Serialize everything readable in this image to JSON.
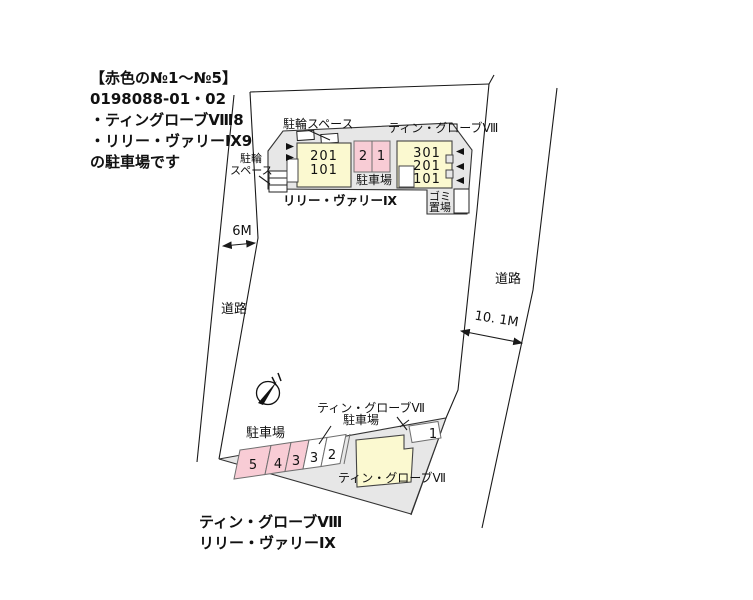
{
  "note": {
    "line1": "【赤色の№1〜№5】",
    "line2": "0198088-01・02",
    "line3": "・ティングローブⅧ8",
    "line4": "・リリー・ヴァリーⅨ9",
    "line5": "の駐車場です"
  },
  "north_block": {
    "bike_space_top": "駐輪スペース",
    "bike_left_line1": "駐輪",
    "bike_left_line2": "スペース",
    "tin_globe8_label": "ティン・グローブⅧ",
    "lily_valley9_label": "リリー・ヴァリーⅨ",
    "bldg9_units": [
      "201",
      "101"
    ],
    "bldg8_units": [
      "301",
      "201",
      "101"
    ],
    "mid_spaces": [
      "2",
      "1"
    ],
    "mid_parking": "駐車場",
    "trash_line1": "ゴミ",
    "trash_line2": "置場"
  },
  "roads": {
    "left_name": "道路",
    "left_width": "6M",
    "right_name": "道路",
    "right_width": "10. 1M"
  },
  "south_block": {
    "parking_left": "駐車場",
    "g7_leader_line1": "ティン・グローブⅦ",
    "g7_leader_line2": "駐車場",
    "spaces": [
      "5",
      "4",
      "3",
      "3",
      "2",
      "1"
    ],
    "g7_building_label": "ティン・グローブⅦ"
  },
  "footer": {
    "line1": "ティン・グローブⅧ",
    "line2": "リリー・ヴァリーⅨ"
  },
  "colors": {
    "parcel_grey": "#e7e7e7",
    "building_yellow": "#fbf9d0",
    "space_pink": "#f8ccd5",
    "line_black": "#1a1a1a"
  }
}
